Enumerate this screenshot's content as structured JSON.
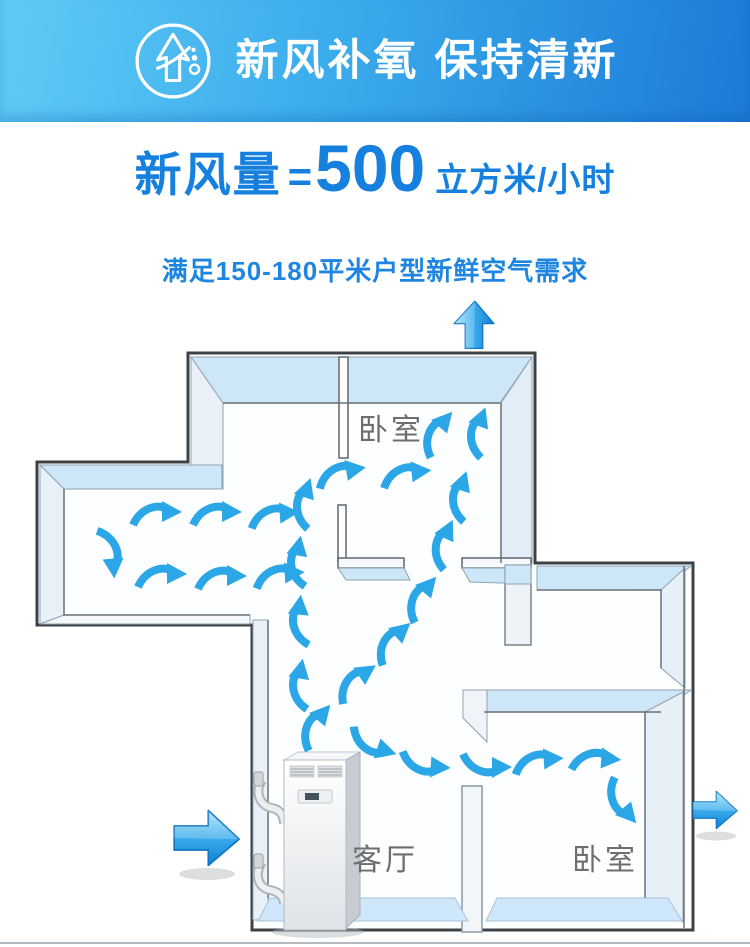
{
  "header": {
    "title": "新风补氧 保持清新",
    "icon": "fresh-air-tree-icon"
  },
  "headline": {
    "prefix": "新风量",
    "equals": "=",
    "value": "500",
    "unit": "立方米/小时"
  },
  "subtitle": "满足150-180平米户型新鲜空气需求",
  "diagram": {
    "rooms": [
      {
        "name": "卧室"
      },
      {
        "name": "客厅"
      },
      {
        "name": "卧室"
      }
    ],
    "device": "floor-standing fresh air ventilation unit",
    "colors": {
      "banner_gradient_left": "#5fcbf5",
      "banner_gradient_right": "#1b7ad6",
      "accent_text_blue": "#1580de",
      "flow_arrow_blue": "#2ba7e8",
      "big_arrow_light": "#a8e4fa",
      "big_arrow_dark": "#0f7fd4",
      "wall_top_blue": "#cde6f8",
      "floor_blue": "#cfe7fb",
      "wall_outline": "#3c4146",
      "room_label_gray": "#6e6e6e"
    },
    "flow_arrows": [
      {
        "x": 155,
        "y": 516,
        "rotate": 0,
        "flip": false
      },
      {
        "x": 215,
        "y": 516,
        "rotate": 0,
        "flip": false
      },
      {
        "x": 273,
        "y": 518,
        "rotate": -4,
        "flip": false
      },
      {
        "x": 160,
        "y": 578,
        "rotate": 0,
        "flip": false
      },
      {
        "x": 220,
        "y": 580,
        "rotate": 0,
        "flip": false
      },
      {
        "x": 278,
        "y": 578,
        "rotate": -4,
        "flip": false
      },
      {
        "x": 108,
        "y": 552,
        "rotate": 85,
        "flip": false
      },
      {
        "x": 316,
        "y": 728,
        "rotate": -50,
        "flip": false
      },
      {
        "x": 302,
        "y": 686,
        "rotate": -80,
        "flip": false
      },
      {
        "x": 302,
        "y": 622,
        "rotate": -84,
        "flip": false
      },
      {
        "x": 300,
        "y": 563,
        "rotate": -80,
        "flip": false
      },
      {
        "x": 306,
        "y": 505,
        "rotate": -72,
        "flip": false
      },
      {
        "x": 356,
        "y": 684,
        "rotate": -35,
        "flip": false
      },
      {
        "x": 393,
        "y": 644,
        "rotate": -42,
        "flip": false
      },
      {
        "x": 422,
        "y": 600,
        "rotate": -50,
        "flip": false
      },
      {
        "x": 445,
        "y": 546,
        "rotate": -65,
        "flip": false
      },
      {
        "x": 462,
        "y": 498,
        "rotate": -72,
        "flip": false
      },
      {
        "x": 340,
        "y": 476,
        "rotate": -10,
        "flip": false
      },
      {
        "x": 405,
        "y": 477,
        "rotate": -6,
        "flip": false
      },
      {
        "x": 438,
        "y": 435,
        "rotate": -50,
        "flip": false
      },
      {
        "x": 480,
        "y": 434,
        "rotate": -70,
        "flip": false
      },
      {
        "x": 372,
        "y": 742,
        "rotate": 18,
        "flip": true
      },
      {
        "x": 424,
        "y": 762,
        "rotate": 4,
        "flip": true
      },
      {
        "x": 485,
        "y": 763,
        "rotate": 0,
        "flip": true
      },
      {
        "x": 537,
        "y": 764,
        "rotate": -4,
        "flip": false
      },
      {
        "x": 594,
        "y": 762,
        "rotate": 4,
        "flip": false
      },
      {
        "x": 622,
        "y": 800,
        "rotate": 50,
        "flip": true
      }
    ],
    "big_arrows": [
      {
        "name": "inflow-arrow-left",
        "x": 205,
        "y": 838,
        "rotate": 0,
        "scale": 1.1
      },
      {
        "name": "outflow-arrow-right",
        "x": 714,
        "y": 810,
        "rotate": 0,
        "scale": 0.75
      },
      {
        "name": "outflow-arrow-top",
        "x": 474,
        "y": 326,
        "rotate": -90,
        "scale": 0.8
      }
    ]
  }
}
